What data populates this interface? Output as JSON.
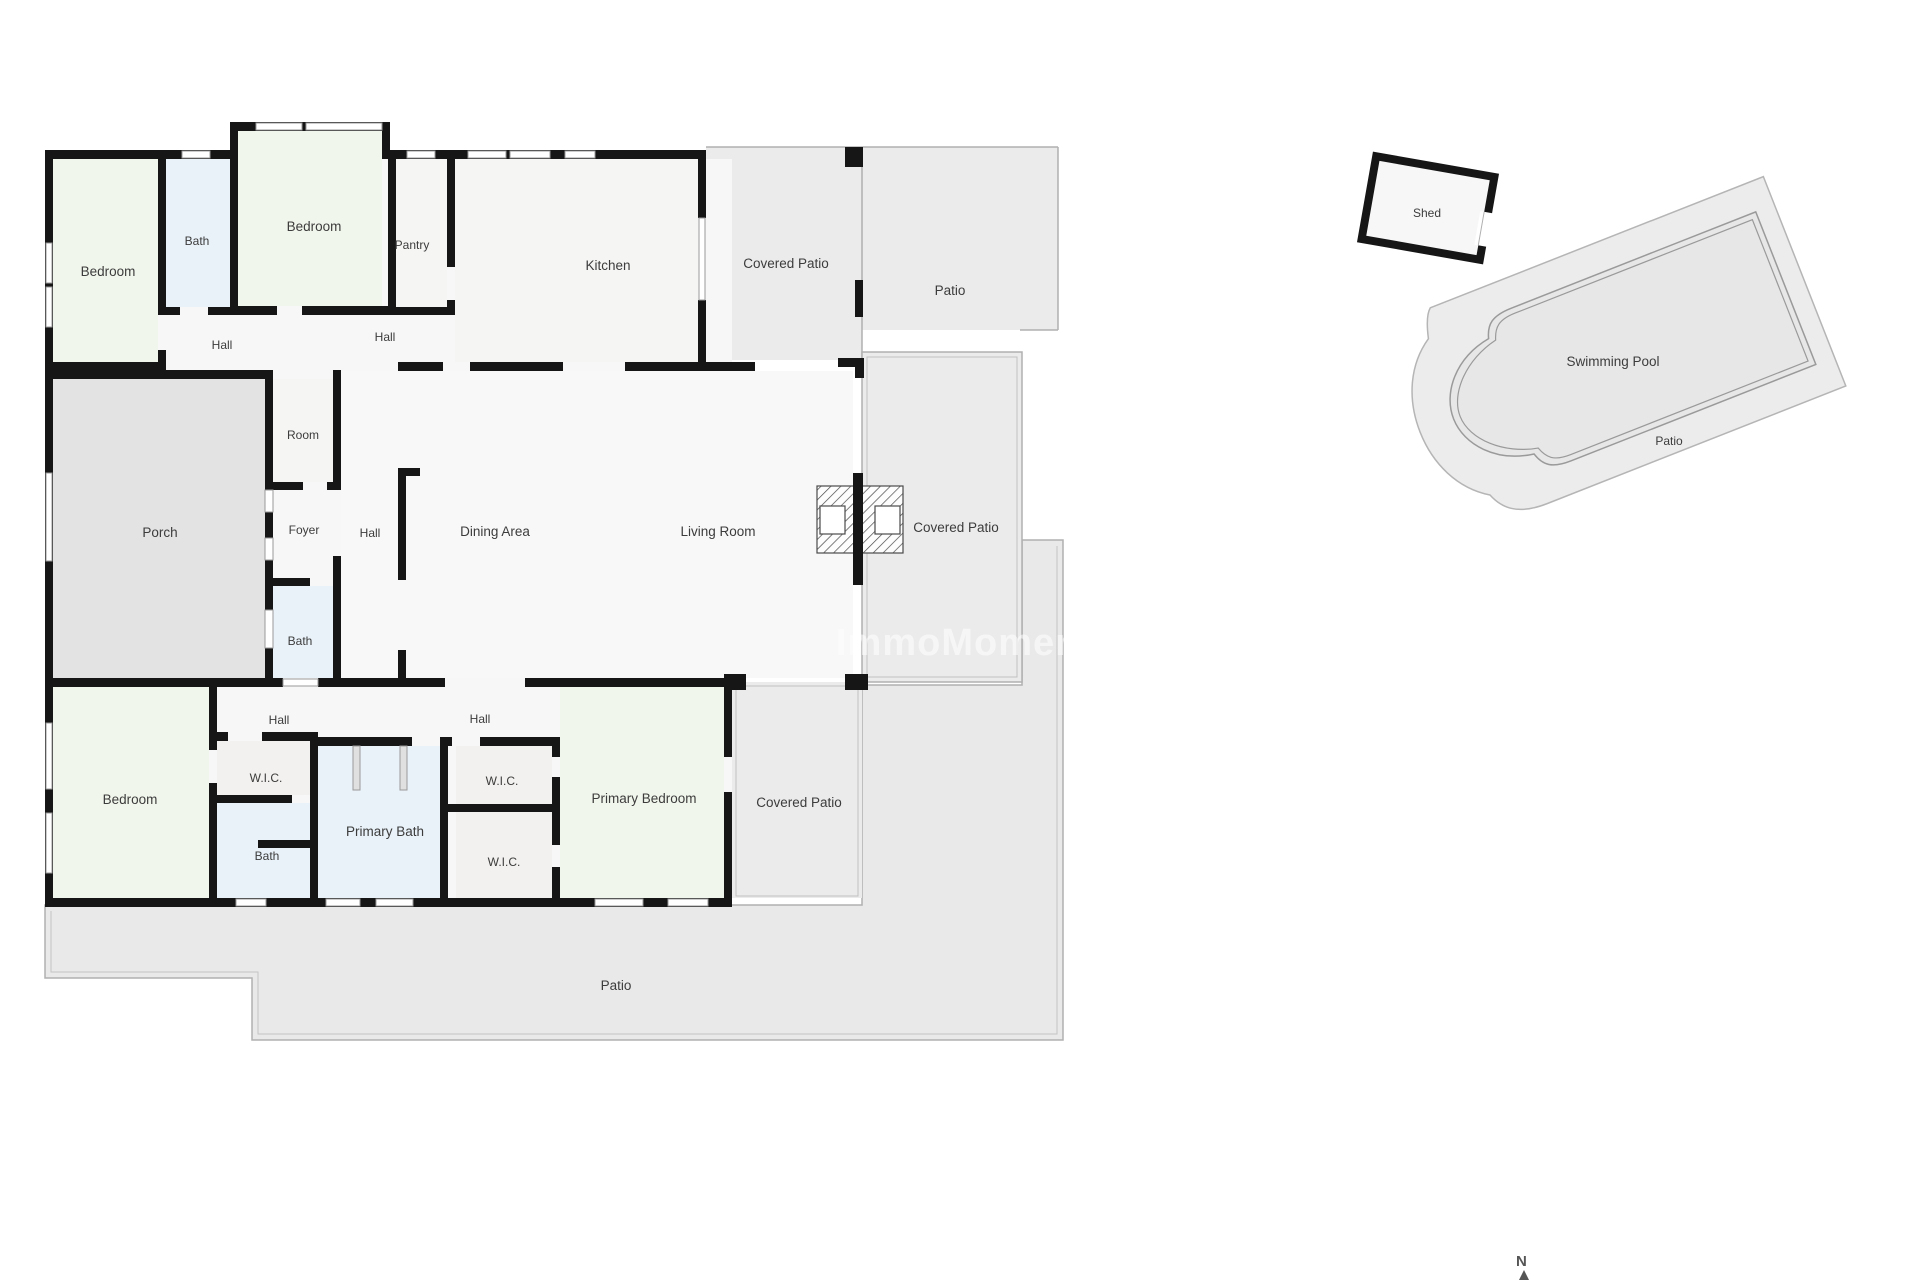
{
  "page": {
    "kind": "floor-plan",
    "background": "#ffffff"
  },
  "colors": {
    "wall": "#161616",
    "room_green": "#f1f6ec",
    "room_blue": "#e9f2f9",
    "room_neutral": "#f5f5f4",
    "interior_base": "#f7f7f7",
    "porch_gray": "#e3e3e3",
    "patio_gray": "#ebebeb",
    "thin_line": "#b0b0b0",
    "label_text": "#3c3c3c",
    "watermark_white": "#ffffff"
  },
  "labels": {
    "bedroom_top_left": "Bedroom",
    "bath_top_left": "Bath",
    "bedroom_top_mid": "Bedroom",
    "pantry": "Pantry",
    "kitchen": "Kitchen",
    "covered_patio_top": "Covered Patio",
    "patio_top_right": "Patio",
    "hall_top_left": "Hall",
    "hall_top_mid": "Hall",
    "room_small": "Room",
    "foyer": "Foyer",
    "hall_center": "Hall",
    "porch": "Porch",
    "dining_area": "Dining Area",
    "living_room": "Living Room",
    "covered_patio_right": "Covered Patio",
    "bath_foyer": "Bath",
    "hall_bottom_left": "Hall",
    "hall_bottom_mid": "Hall",
    "bedroom_bottom_left": "Bedroom",
    "wic_left": "W.I.C.",
    "bath_bottom": "Bath",
    "primary_bath": "Primary Bath",
    "wic_mid_upper": "W.I.C.",
    "wic_mid_lower": "W.I.C.",
    "primary_bedroom": "Primary Bedroom",
    "covered_patio_bottom": "Covered Patio",
    "patio_bottom": "Patio",
    "shed": "Shed",
    "swimming_pool": "Swimming Pool",
    "patio_pool": "Patio",
    "watermark": "ImmoMoment.e",
    "compass_n": "N"
  }
}
